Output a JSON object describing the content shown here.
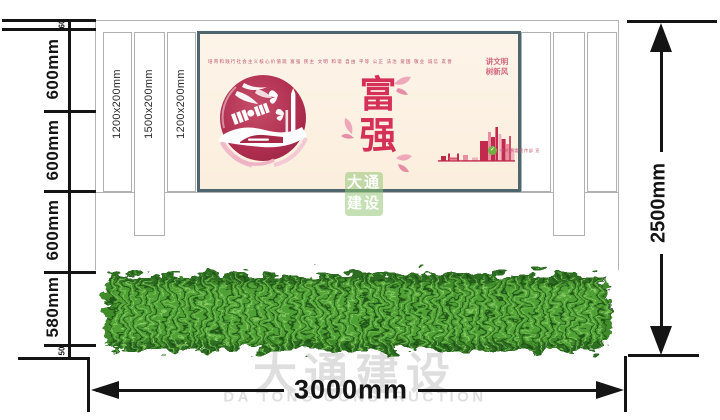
{
  "drawing": {
    "total_width_label": "3000mm",
    "total_height_label": "2500mm",
    "left_segments": [
      "60",
      "600mm",
      "600mm",
      "600mm",
      "580mm",
      "50"
    ],
    "pillar_labels": [
      "1200x200mm",
      "1500x200mm",
      "1200x200mm"
    ]
  },
  "poster": {
    "core_values_line": "培育和践行社会主义核心价值观  富强 民主 文明 和谐 自由 平等 公正 法治 爱国 敬业 诚信 友善",
    "slogan": [
      "讲文明",
      "树新风"
    ],
    "theme_chars": [
      "富",
      "强"
    ],
    "credit_line": "中共市委宣传部 宣"
  },
  "watermark": {
    "seal_lines": [
      "大通",
      "建设"
    ],
    "brand_cn": "大通建设",
    "brand_en": "DA TONG CONSTRUCTION"
  },
  "colors": {
    "crimson": "#c22a4d",
    "pink_light": "#f0b3c0",
    "pink_mid": "#e8899d",
    "poster_bg": "#fcf1e2",
    "poster_frame": "#4d666d",
    "hedge_green": "#3f8c2c",
    "dimension_black": "#141414",
    "watermark_gray": "#d7d7d7",
    "badge_green": "#72b043"
  }
}
